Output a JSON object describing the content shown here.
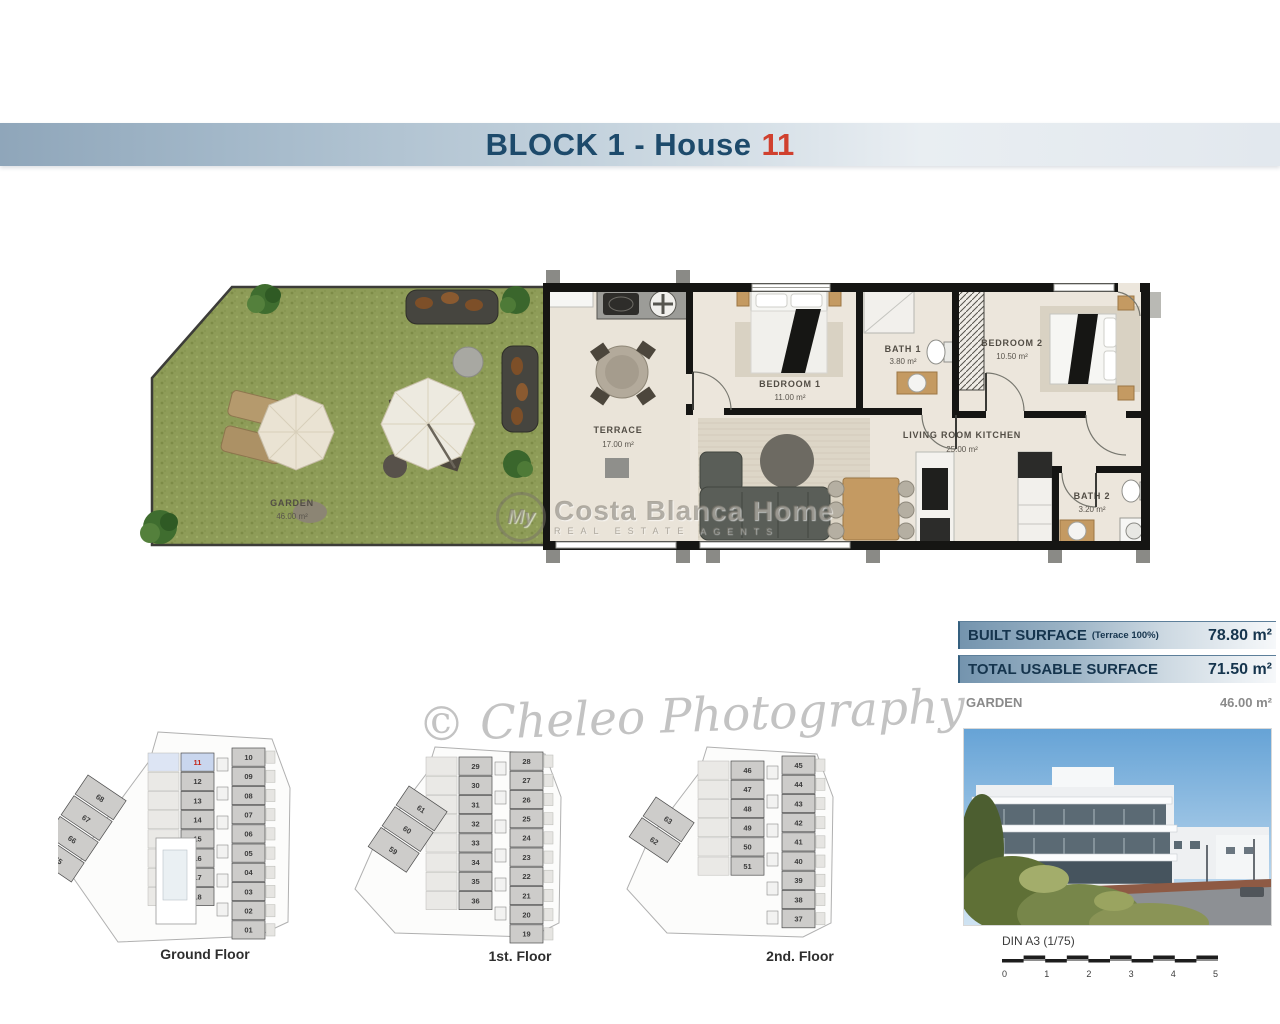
{
  "header": {
    "title": "BLOCK 1 - House",
    "number": "11",
    "text_color": "#1d4a6b",
    "number_color": "#d0402e"
  },
  "plan": {
    "rooms": {
      "garden": {
        "name": "GARDEN",
        "area": "46.00 m²"
      },
      "terrace": {
        "name": "TERRACE",
        "area": "17.00 m²"
      },
      "bedroom1": {
        "name": "BEDROOM 1",
        "area": "11.00 m²"
      },
      "bath1": {
        "name": "BATH 1",
        "area": "3.80 m²"
      },
      "bedroom2": {
        "name": "BEDROOM 2",
        "area": "10.50 m²"
      },
      "living": {
        "name": "LIVING ROOM KITCHEN",
        "area": "25.00 m²"
      },
      "bath2": {
        "name": "BATH 2",
        "area": "3.20 m²"
      }
    }
  },
  "surface_table": {
    "rows": [
      {
        "label": "BUILT SURFACE",
        "note": "(Terrace 100%)",
        "value": "78.80 m²"
      },
      {
        "label": "TOTAL USABLE SURFACE",
        "note": "",
        "value": "71.50 m²"
      },
      {
        "label": "GARDEN",
        "note": "",
        "value": "46.00 m²"
      }
    ]
  },
  "mini_plans": [
    {
      "label": "Ground Floor",
      "highlight": "11",
      "left_units": [
        "11",
        "12",
        "13",
        "14",
        "15",
        "16",
        "17",
        "18"
      ],
      "right_units": [
        "10",
        "09",
        "08",
        "07",
        "06",
        "05",
        "04",
        "03",
        "02",
        "01"
      ],
      "wing_units": [
        "68",
        "67",
        "66",
        "65"
      ]
    },
    {
      "label": "1st. Floor",
      "highlight": "",
      "left_units": [
        "29",
        "30",
        "31",
        "32",
        "33",
        "34",
        "35",
        "36"
      ],
      "right_units": [
        "28",
        "27",
        "26",
        "25",
        "24",
        "23",
        "22",
        "21",
        "20",
        "19"
      ],
      "wing_units": [
        "61",
        "60",
        "59"
      ]
    },
    {
      "label": "2nd. Floor",
      "highlight": "",
      "left_units": [
        "46",
        "47",
        "48",
        "49",
        "50",
        "51"
      ],
      "right_units": [
        "45",
        "44",
        "43",
        "42",
        "41",
        "40",
        "39",
        "38",
        "37"
      ],
      "wing_units": [
        "63",
        "62"
      ]
    }
  ],
  "photo_footer": {
    "scale_label": "DIN A3 (1/75)",
    "ticks": [
      "0",
      "1",
      "2",
      "3",
      "4",
      "5"
    ]
  },
  "watermarks": {
    "brand_prefix": "My",
    "brand_name": "Costa Blanca Home",
    "brand_tagline": "REAL ESTATE AGENTS",
    "photo_credit": "© Cheleo Photography"
  },
  "colors": {
    "highlight_unit_bg": "#c9d6ee",
    "highlight_unit_text": "#c2271a",
    "band_left": "#8fa6ba",
    "grass": "#8e9c58"
  }
}
